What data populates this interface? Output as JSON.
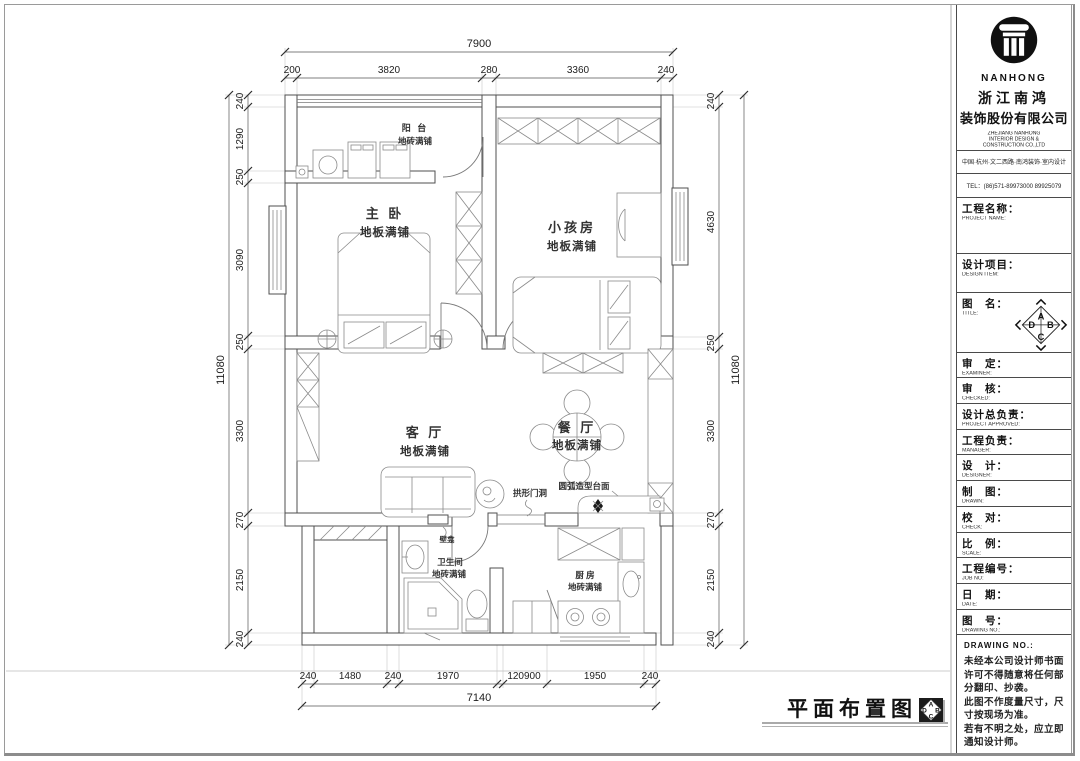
{
  "company": {
    "logo_text": "NANHONG",
    "name_line1": "浙江南鸿",
    "name_line2": "装饰股份有限公司",
    "en_line1": "ZHEJIANG NANHONG",
    "en_line2": "INTERIOR DESIGN &",
    "en_line3": "CONSTRUCTION CO.,LTD",
    "address": "中国·杭州·文二西路·南鸿装饰·室内设计",
    "tel": "TEL：(86)571-89973000  89925079"
  },
  "title_block": {
    "fields": [
      {
        "cn": "工程名称：",
        "en": "PROJECT NAME:"
      },
      {
        "cn": "设计项目：",
        "en": "DESIGN ITEM:"
      },
      {
        "cn": "图　名：",
        "en": "TITLE:"
      },
      {
        "cn": "审　定：",
        "en": "EXAMINER:"
      },
      {
        "cn": "审　核：",
        "en": "CHECKED:"
      },
      {
        "cn": "设计总负责：",
        "en": "PROJECT APPROVED:"
      },
      {
        "cn": "工程负责：",
        "en": "MANAGER:"
      },
      {
        "cn": "设　计：",
        "en": "DESIGNER:"
      },
      {
        "cn": "制　图：",
        "en": "DRAWN:"
      },
      {
        "cn": "校　对：",
        "en": "CHECK:"
      },
      {
        "cn": "比　例：",
        "en": "SCALE:"
      },
      {
        "cn": "工程编号：",
        "en": "JOB NO:"
      },
      {
        "cn": "日　期：",
        "en": "DATE:"
      },
      {
        "cn": "图　号：",
        "en": "DRAWING NO.:"
      }
    ],
    "notes_header": "DRAWING NO.:",
    "notes": [
      "未经本公司设计师书面",
      "许可不得随意将任何部",
      "分翻印、抄袭。",
      "此图不作度量尺寸，尺",
      "寸按现场为准。",
      "若有不明之处，应立即",
      "通知设计师。"
    ],
    "compass": {
      "a": "A",
      "b": "B",
      "c": "C",
      "d": "D"
    }
  },
  "plan": {
    "rooms": {
      "balcony": {
        "name": "阳 台",
        "floor": "地砖满铺"
      },
      "master": {
        "name": "主 卧",
        "floor": "地板满铺"
      },
      "kids": {
        "name": "小孩房",
        "floor": "地板满铺"
      },
      "living": {
        "name": "客 厅",
        "floor": "地板满铺"
      },
      "dining": {
        "name": "餐 厅",
        "floor": "地板满铺"
      },
      "bath": {
        "name": "卫生间",
        "floor": "地砖满铺"
      },
      "kitchen": {
        "name": "厨 房",
        "floor": "地砖满铺"
      }
    },
    "annotations": {
      "arch_door": "拱形门洞",
      "curved_counter": "圆弧造型台面",
      "niche": "壁龛"
    }
  },
  "dims": {
    "top": {
      "total": "7900",
      "segments": [
        "200",
        "3820",
        "280",
        "3360",
        "240"
      ]
    },
    "bottom": {
      "total": "7140",
      "segments": [
        "240",
        "1480",
        "240",
        "1970",
        "120900",
        "1950",
        "240"
      ]
    },
    "left": {
      "total": "11080",
      "segments": [
        "240",
        "1290",
        "250",
        "3090",
        "250",
        "3300",
        "270",
        "2150",
        "240"
      ]
    },
    "right": {
      "total": "11080",
      "segments": [
        "240",
        "4630",
        "250",
        "3300",
        "270",
        "2150",
        "240"
      ]
    }
  },
  "footer": {
    "title": "平面布置图"
  }
}
